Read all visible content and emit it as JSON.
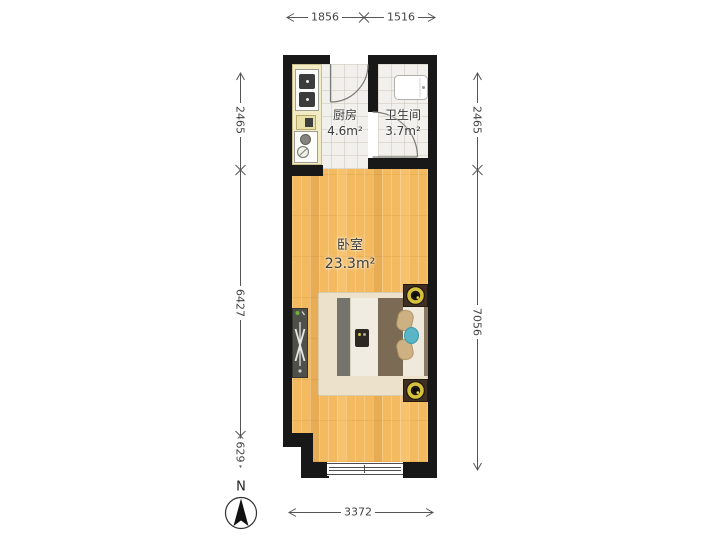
{
  "page": {
    "background": "#ffffff",
    "type": "apartment-floor-plan"
  },
  "rooms": {
    "kitchen": {
      "name": "厨房",
      "area": "4.6m²"
    },
    "bathroom": {
      "name": "卫生间",
      "area": "3.7m²"
    },
    "bedroom": {
      "name": "卧室",
      "area": "23.3m²"
    }
  },
  "dimensions": {
    "top": [
      "1856",
      "1516"
    ],
    "left": [
      "2465",
      "6427",
      "629"
    ],
    "right": [
      "2465",
      "7056"
    ],
    "bottom": [
      "3372"
    ]
  },
  "compass": {
    "label": "N"
  },
  "furniture": {
    "kitchen": [
      "kitchen-counter",
      "stove-two-burners",
      "kitchen-sink"
    ],
    "bathroom": [
      "washing-machine"
    ],
    "bedroom": [
      "double-bed",
      "pillows",
      "nightstand-with-lamp-top",
      "nightstand-with-lamp-bottom",
      "rug",
      "radiator",
      "bottom-window"
    ]
  },
  "colors": {
    "wall": "#181818",
    "wood_floor": "#f3ba60",
    "tile_floor": "#f2f0ec",
    "counter": "#f2ebc4",
    "lamp_accent": "#d7c23c",
    "bed_blanket_brown": "#7b6b54",
    "teal_accent": "#5ab5c6",
    "dimension_text": "#444444"
  }
}
